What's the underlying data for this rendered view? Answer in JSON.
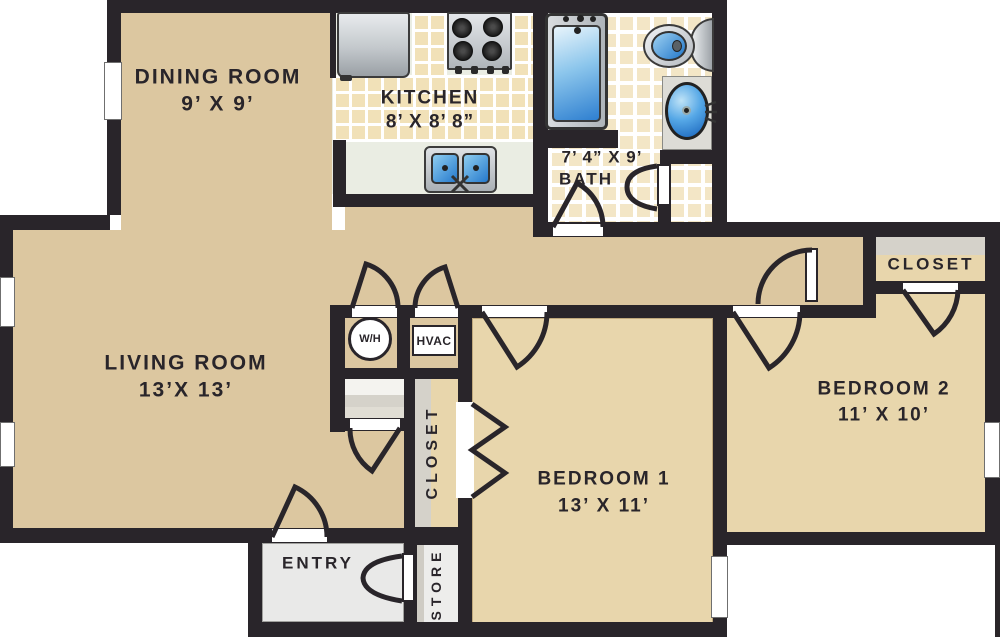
{
  "plan": {
    "rooms": {
      "dining": {
        "name": "DINING ROOM",
        "dims": "9’ X 9’"
      },
      "kitchen": {
        "name": "KITCHEN",
        "dims": "8’ X 8’ 8”"
      },
      "bath": {
        "dims": "7’ 4” X 9’",
        "name": "BATH"
      },
      "living": {
        "name": "LIVING ROOM",
        "dims": "13’X 13’"
      },
      "bedroom1": {
        "name": "BEDROOM 1",
        "dims": "13’ X 11’"
      },
      "bedroom2": {
        "name": "BEDROOM 2",
        "dims": "11’ X 10’"
      },
      "entry": {
        "name": "ENTRY"
      },
      "store": {
        "name": "STORE"
      },
      "hall_closet": {
        "name": "CLOSET"
      },
      "bedroom2_closet": {
        "name": "CLOSET"
      }
    },
    "utilities": {
      "water_heater": {
        "label": "W/H"
      },
      "hvac": {
        "label": "HVAC"
      }
    },
    "colors": {
      "wall": "#29252a",
      "floor_main": "#dcc7a0",
      "floor_bedroom": "#e8d6ac",
      "kitchen_floor": "#eaede3",
      "bath_floor": "#fbf8ee",
      "tile": "#f1e1b8",
      "fixture_blue": "#2e7fd0",
      "metal": "#c6cacd",
      "shelf_gray": "#d5d2ca",
      "entry_gray": "#e9e9e8"
    }
  }
}
